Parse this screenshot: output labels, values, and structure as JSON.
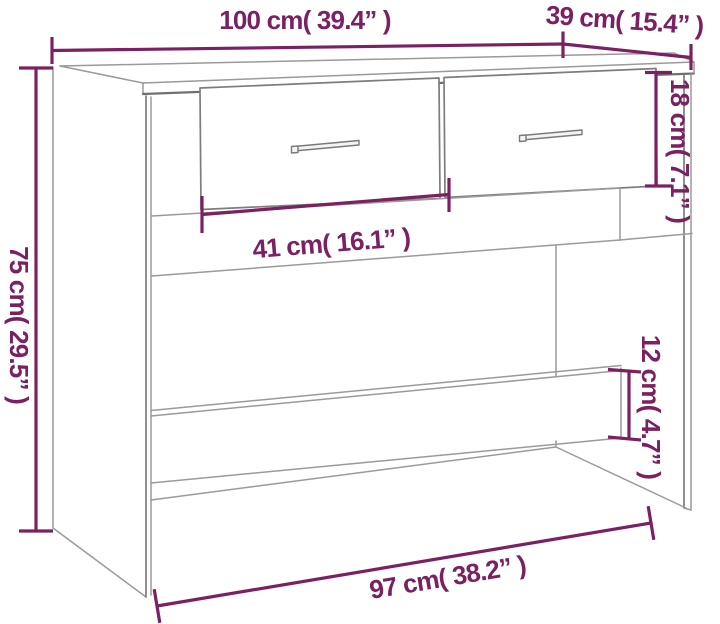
{
  "diagram": {
    "kind": "furniture-dimension-diagram",
    "item": "console table with two drawers and lower stretcher shelf",
    "colors": {
      "dimension_accent": "#7a2063",
      "outline_gray": "#9a9a9a",
      "outline_dark_gray": "#6f6f6f",
      "background": "#ffffff"
    },
    "dimensions": {
      "top_width": {
        "cm": 100,
        "inch": 39.4,
        "label": "100 cm( 39.4” )"
      },
      "top_depth": {
        "cm": 39,
        "inch": 15.4,
        "label": "39 cm( 15.4” )"
      },
      "height": {
        "cm": 75,
        "inch": 29.5,
        "label": "75 cm( 29.5” )"
      },
      "drawer_height": {
        "cm": 18,
        "inch": 7.1,
        "label": "18 cm( 7.1” )"
      },
      "drawer_width": {
        "cm": 41,
        "inch": 16.1,
        "label": "41 cm( 16.1” )"
      },
      "stretcher_height": {
        "cm": 12,
        "inch": 4.7,
        "label": "12 cm( 4.7” )"
      },
      "base_width": {
        "cm": 97,
        "inch": 38.2,
        "label": "97 cm( 38.2” )"
      }
    }
  }
}
